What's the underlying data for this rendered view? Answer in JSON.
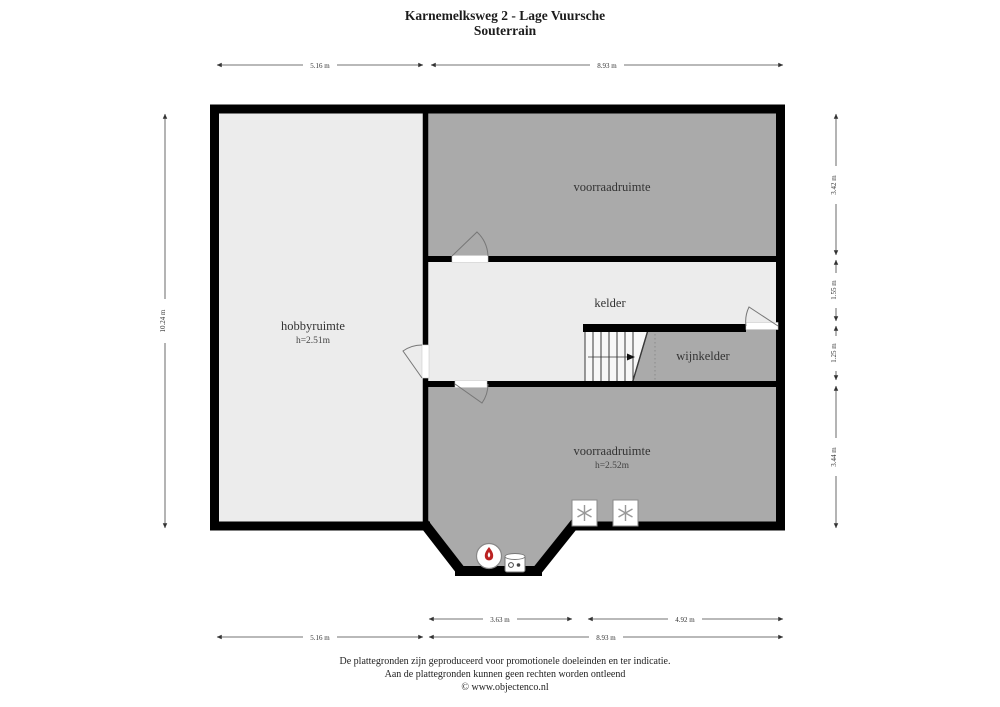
{
  "page": {
    "title_line1": "Karnemelksweg 2 - Lage Vuursche",
    "title_line2": "Souterrain"
  },
  "rooms": {
    "voorraadruimte_top": {
      "label": "voorraadruimte"
    },
    "kelder": {
      "label": "kelder"
    },
    "wijnkelder": {
      "label": "wijnkelder"
    },
    "hobbyruimte": {
      "label": "hobbyruimte",
      "height": "h=2.51m"
    },
    "voorraadruimte_bottom": {
      "label": "voorraadruimte",
      "height": "h=2.52m"
    }
  },
  "dimensions": {
    "top_left": "5.16 m",
    "top_right": "8.93 m",
    "left": "10.24 m",
    "right_top": "3.42 m",
    "right_upper_mid": "1.55 m",
    "right_lower_mid": "1.25 m",
    "right_bottom": "3.44 m",
    "bottom_inner_left": "3.63 m",
    "bottom_inner_right": "4.92 m",
    "bottom_outer_left": "5.16 m",
    "bottom_outer_right": "8.93 m"
  },
  "icons": {
    "freezer_icon": "asterisk-cooling-symbol",
    "burner_icon": "red-flame-boiler-symbol",
    "boiler_icon": "cylinder-water-heater-symbol",
    "stairs_icon": "staircase-up-symbol"
  },
  "footer": {
    "line1": "De plattegronden zijn geproduceerd voor promotionele doeleinden en ter indicatie.",
    "line2": "Aan de plattegronden kunnen geen rechten worden ontleend",
    "line3": "© www.objectenco.nl"
  },
  "colors": {
    "wall": "#000000",
    "room_light": "#ececec",
    "room_medium": "#aaaaaa",
    "flame_red": "#bb2222"
  }
}
